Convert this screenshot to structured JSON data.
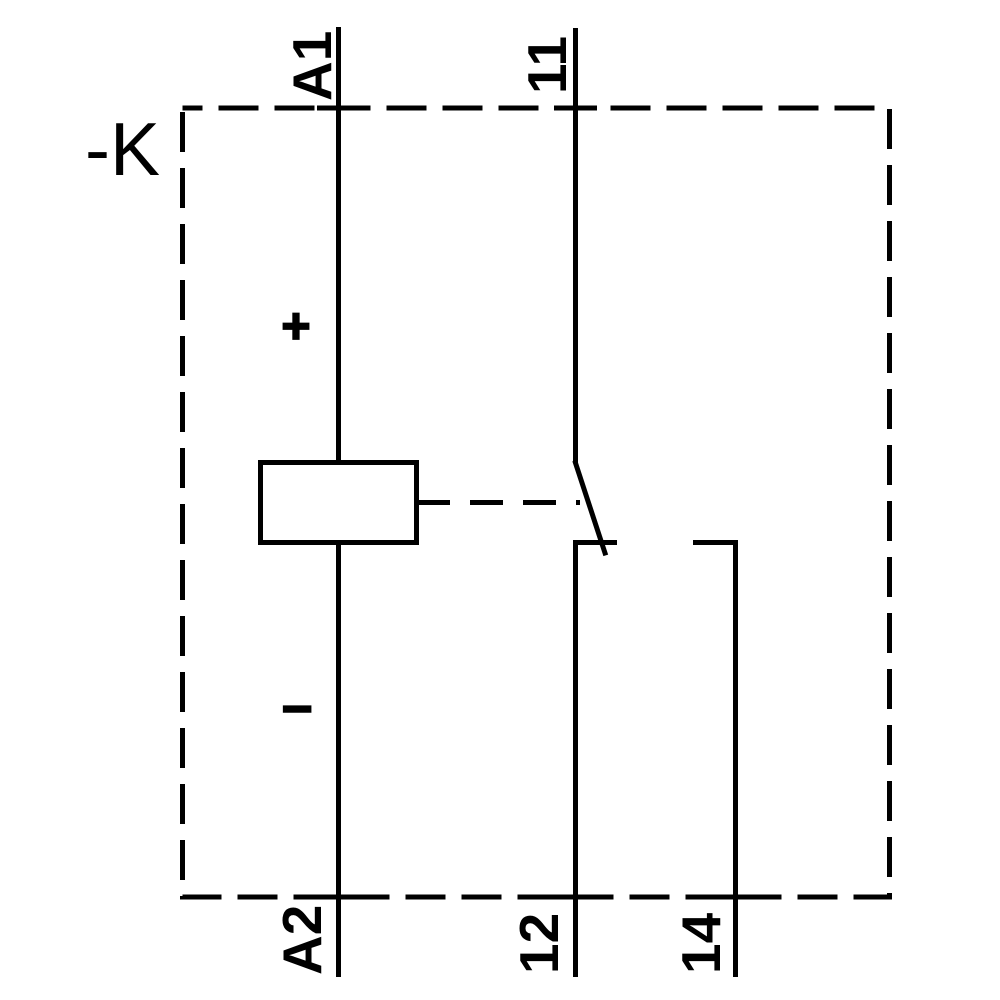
{
  "schematic": {
    "type": "relay-wiring-diagram",
    "device_label": "-K",
    "terminals": {
      "coil_top": "A1",
      "coil_bottom": "A2",
      "contact_common": "11",
      "contact_nc": "12",
      "contact_no": "14"
    },
    "polarity": {
      "positive": "+",
      "negative": "−"
    },
    "colors": {
      "ink": "#000000",
      "background": "#ffffff"
    }
  }
}
